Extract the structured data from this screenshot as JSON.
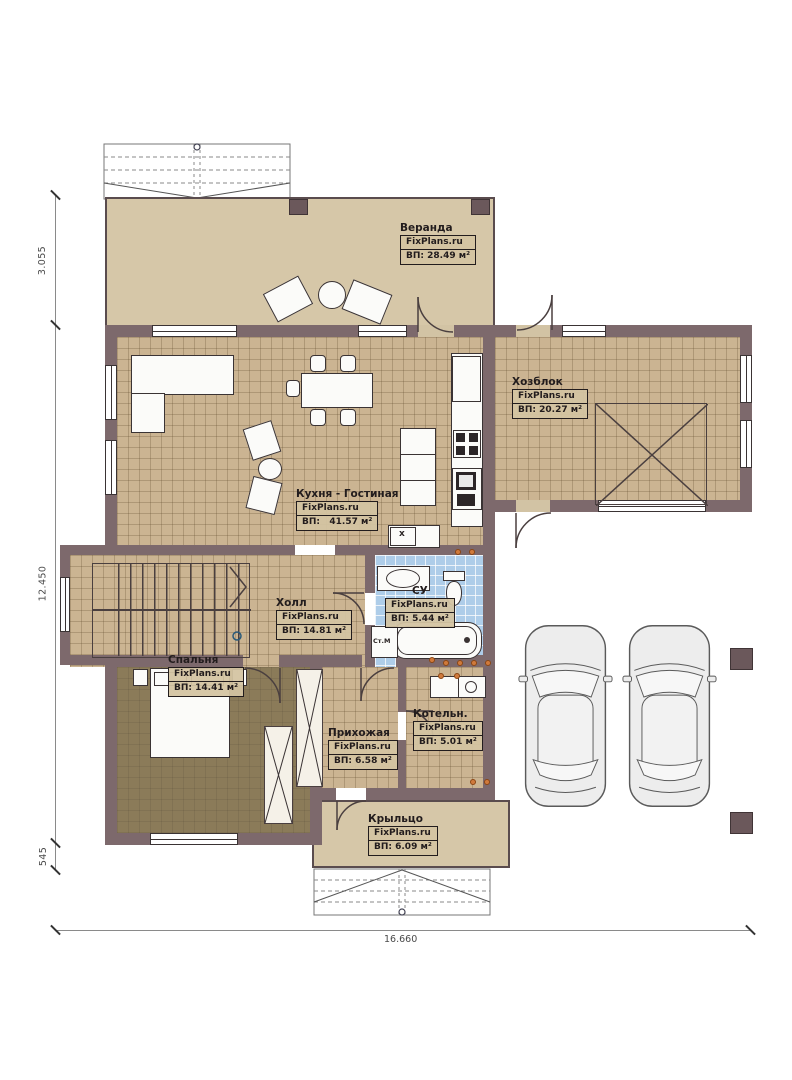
{
  "plan_title": "FixPlans.ru floor plan",
  "brand": "FixPlans.ru",
  "rooms": [
    {
      "id": "veranda",
      "name": "Веранда",
      "brand": "FixPlans.ru",
      "area": "ВП: 28.49 м²"
    },
    {
      "id": "hozblok",
      "name": "Хозблок",
      "brand": "FixPlans.ru",
      "area": "ВП: 20.27 м²"
    },
    {
      "id": "kitchen_living",
      "name": "Кухня - Гостиная",
      "brand": "FixPlans.ru",
      "area": "ВП:   41.57 м²"
    },
    {
      "id": "hall",
      "name": "Холл",
      "brand": "FixPlans.ru",
      "area": "ВП: 14.81 м²"
    },
    {
      "id": "bathroom",
      "name": "СУ",
      "brand": "FixPlans.ru",
      "area": "ВП: 5.44 м²"
    },
    {
      "id": "bedroom",
      "name": "Спальня",
      "brand": "FixPlans.ru",
      "area": "ВП: 14.41 м²"
    },
    {
      "id": "entry",
      "name": "Прихожая",
      "brand": "FixPlans.ru",
      "area": "ВП: 6.58 м²"
    },
    {
      "id": "boiler",
      "name": "Котельн.",
      "brand": "FixPlans.ru",
      "area": "ВП: 5.01 м²"
    },
    {
      "id": "porch",
      "name": "Крыльцо",
      "brand": "FixPlans.ru",
      "area": "ВП: 6.09 м²"
    }
  ],
  "dims": {
    "veranda_depth": "3.055",
    "house_depth": "12.450",
    "porch_step": "545",
    "total_width": "16.660"
  },
  "extras": {
    "washing_machine": "Ст.М",
    "vent_box": "x"
  },
  "colors": {
    "wall": "#7d696c",
    "floor_tan": "#cbb492",
    "veranda_tan": "#d6c7a8",
    "bedroom_floor": "#8b7b59",
    "bath_tile": "#aecde9",
    "accent_dot": "#d07a3c"
  }
}
